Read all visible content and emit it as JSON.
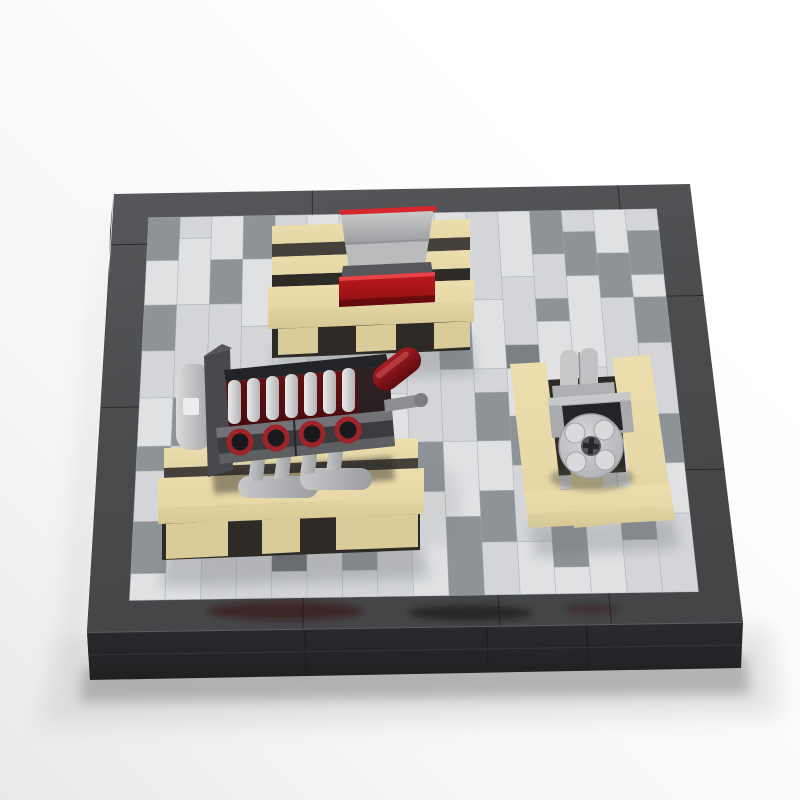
{
  "scene": {
    "description": "LEGO workshop diorama photo: dark baseplate with gray plank-tiled floor, tan pallet with gray and red crates, black V8 engine block on a pallet, and a gray pulley machine on a pallet",
    "objects": [
      "baseplate",
      "tiled-floor",
      "crate-pallet",
      "gray-crate",
      "red-crate",
      "v8-engine",
      "engine-pallet",
      "pulley-machine",
      "machine-pallet"
    ]
  },
  "colors": {
    "bg": {
      "top": "#ffffff",
      "mid": "#f7f6f6",
      "bottom": "#eae9e9"
    },
    "base": {
      "borderTop": "#4a4c4e",
      "borderTopLight": "#56585b",
      "wallFront": "#2a2b2e",
      "wallFrontDark": "#1f2022",
      "wallLeft": "#37383b",
      "seam": "#1b1c1e",
      "edgeHighlight": "#5a5c5f",
      "reflectRed": "#3a0d10",
      "reflectDark": "#141416"
    },
    "floor": {
      "base": "#ccced1",
      "shades": {
        "w": "#dfe1e3",
        "l": "#d3d5d8",
        "m": "#8e9398",
        "n": "#7b8085",
        "d": "#676c71"
      },
      "seam": "#a6aaae"
    },
    "pallet": {
      "top": "#ecdfad",
      "mid": "#e4d7a5",
      "front": "#d6c894",
      "foot": "#d9cc98",
      "gap": "#45403a",
      "gapDark": "#2e2b26"
    },
    "crate": {
      "redTop": "#d8262c",
      "red": "#c01a1f",
      "redDark": "#8c1014",
      "redEdge": "#ef474c",
      "gray": "#b9bbbd",
      "grayDark": "#9b9da0",
      "lip": "#56575a"
    },
    "engine": {
      "block": "#3a3b3e",
      "blockDark": "#232427",
      "rail": "#717376",
      "railLow": "#5d5f62",
      "bayRed": "#6a1114",
      "bayRedDark": "#470b0d",
      "ringRed": "#9e2429",
      "ringCore": "#191a1c",
      "piston": "#e8e9ea",
      "pistonDark": "#b2b4b6",
      "pipe": "#c6c8ca",
      "pipeDark": "#9b9da0",
      "damper": "#d8dadb",
      "bracket": "#48494c",
      "capsule": "#a61b21",
      "capsuleDark": "#5f0c10",
      "axle": "#8c8e91"
    },
    "machine": {
      "plate": "#aeb0b3",
      "plateLight": "#c6c8ca",
      "body": "#a8aaad",
      "recess": "#232427",
      "hub": "#d3d5d7",
      "hubEdge": "#a9abae",
      "stud": "#d8dadc",
      "studEdge": "#9fa1a4",
      "hole": "#54565a",
      "cross": "#26272a"
    },
    "shadow": "#8e8c8a"
  },
  "floor_map": {
    "columns": 16,
    "rows": 16,
    "planks": [
      [
        [
          "m",
          2
        ],
        [
          "w",
          2
        ],
        [
          "m",
          2
        ],
        [
          "l",
          2
        ],
        [
          "w",
          2
        ],
        [
          "m",
          1
        ],
        [
          "l",
          2
        ],
        [
          "m",
          2
        ],
        [
          "w",
          1
        ]
      ],
      [
        [
          "l",
          1
        ],
        [
          "w",
          3
        ],
        [
          "l",
          4
        ],
        [
          "m",
          2
        ],
        [
          "l",
          2
        ],
        [
          "m",
          2
        ],
        [
          "w",
          2
        ]
      ],
      [
        [
          "w",
          2
        ],
        [
          "m",
          2
        ],
        [
          "l",
          3
        ],
        [
          "w",
          4
        ],
        [
          "m",
          2
        ],
        [
          "l",
          3
        ]
      ],
      [
        [
          "m",
          2
        ],
        [
          "w",
          3
        ],
        [
          "l",
          4
        ],
        [
          "w",
          3
        ],
        [
          "m",
          2
        ],
        [
          "l",
          2
        ]
      ],
      [
        [
          "l",
          3
        ],
        [
          "w",
          4
        ],
        [
          "l",
          3
        ],
        [
          "w",
          2
        ],
        [
          "d",
          3
        ],
        [
          "l",
          1
        ]
      ],
      [
        [
          "w",
          4
        ],
        [
          "l",
          3
        ],
        [
          "w",
          5
        ],
        [
          "n",
          2
        ],
        [
          "l",
          2
        ]
      ],
      [
        [
          "l",
          2
        ],
        [
          "w",
          3
        ],
        [
          "l",
          4
        ],
        [
          "w",
          4
        ],
        [
          "m",
          2
        ],
        [
          "l",
          1
        ]
      ],
      [
        [
          "w",
          3
        ],
        [
          "m",
          1
        ],
        [
          "l",
          4
        ],
        [
          "w",
          4
        ],
        [
          "l",
          4
        ]
      ],
      [
        [
          "l",
          3
        ],
        [
          "w",
          1
        ],
        [
          "m",
          2
        ],
        [
          "l",
          4
        ],
        [
          "m",
          2
        ],
        [
          "w",
          4
        ]
      ],
      [
        [
          "w",
          4
        ],
        [
          "m",
          3
        ],
        [
          "l",
          3
        ],
        [
          "w",
          3
        ],
        [
          "m",
          3
        ]
      ],
      [
        [
          "l",
          4
        ],
        [
          "w",
          3
        ],
        [
          "l",
          1
        ],
        [
          "m",
          2
        ],
        [
          "w",
          2
        ],
        [
          "m",
          2
        ],
        [
          "l",
          2
        ]
      ],
      [
        [
          "w",
          3
        ],
        [
          "l",
          3
        ],
        [
          "n",
          1
        ],
        [
          "w",
          2
        ],
        [
          "m",
          2
        ],
        [
          "l",
          3
        ],
        [
          "w",
          2
        ]
      ],
      [
        [
          "m",
          2
        ],
        [
          "l",
          2
        ],
        [
          "m",
          1
        ],
        [
          "w",
          4
        ],
        [
          "l",
          3
        ],
        [
          "m",
          3
        ],
        [
          "w",
          1
        ]
      ],
      [
        [
          "l",
          1
        ],
        [
          "m",
          2
        ],
        [
          "w",
          4
        ],
        [
          "l",
          4
        ],
        [
          "w",
          5
        ]
      ],
      [
        [
          "w",
          2
        ],
        [
          "m",
          2
        ],
        [
          "l",
          4
        ],
        [
          "w",
          4
        ],
        [
          "m",
          2
        ],
        [
          "l",
          2
        ]
      ],
      [
        [
          "l",
          1
        ],
        [
          "m",
          2
        ],
        [
          "w",
          1
        ],
        [
          "m",
          2
        ],
        [
          "l",
          3
        ],
        [
          "m",
          2
        ],
        [
          "w",
          2
        ],
        [
          "l",
          3
        ]
      ]
    ]
  },
  "border_seams": {
    "top_u": [
      0.345,
      0.875
    ],
    "bottom_u": [
      0.33,
      0.63,
      0.8
    ],
    "left_v": [
      0.13,
      0.52
    ],
    "right_v": [
      0.28,
      0.68
    ]
  }
}
